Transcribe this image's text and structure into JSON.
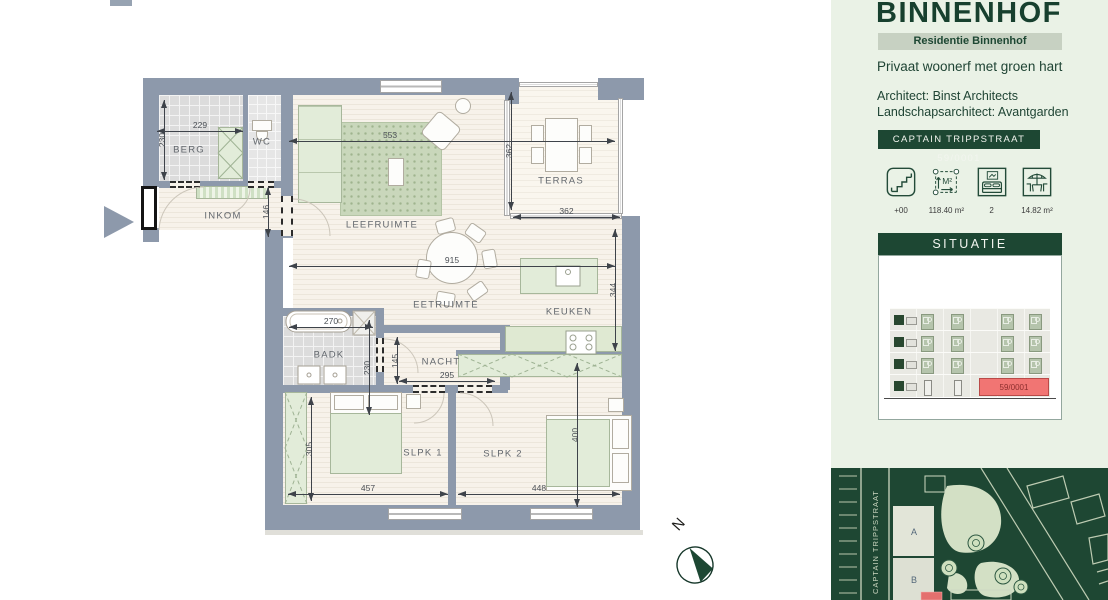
{
  "sidebar": {
    "title": "BINNENHOF",
    "badge": "Residentie Binnenhof",
    "tagline": "Privaat woonerf met groen hart",
    "architect_line1": "Architect: Binst Architects",
    "architect_line2": "Landschapsarchitect: Avantgarden",
    "address_bar": "CAPTAIN TRIPPSTRAAT 59/0001",
    "stats": [
      {
        "icon": "stairs-icon",
        "label": "+00"
      },
      {
        "icon": "area-icon",
        "label": "118.40 m²",
        "glyph": "M²"
      },
      {
        "icon": "bed-icon",
        "label": "2"
      },
      {
        "icon": "terrace-icon",
        "label": "14.82 m²"
      }
    ],
    "situatie": {
      "header": "SITUATIE",
      "highlight_unit": "59/0001"
    },
    "map": {
      "street": "CAPTAIN TRIPPSTRAAT",
      "building_a": "A",
      "building_b": "B"
    }
  },
  "plan": {
    "compass_label": "N",
    "rooms": {
      "berg": "BERG",
      "wc": "WC",
      "inkom": "INKOM",
      "leefruimte": "LEEFRUIMTE",
      "terras": "TERRAS",
      "eetruimte": "EETRUIMTE",
      "keuken": "KEUKEN",
      "badk": "BADK",
      "nacht": "NACHT",
      "slpk1": "SLPK 1",
      "slpk2": "SLPK 2"
    },
    "dims": {
      "berg_w": "229",
      "berg_h": "230",
      "inkom_h": "146",
      "leefruimte_w": "553",
      "terras_h": "362",
      "terras_w": "362",
      "eetruimte_w": "915",
      "keuken_h": "344",
      "badk_w": "270",
      "badk_h": "230",
      "nacht_h": "145",
      "nacht_w": "295",
      "slpk1_h": "305",
      "slpk1_w": "457",
      "slpk2_h": "400",
      "slpk2_w": "448"
    }
  },
  "colors": {
    "accent_green": "#1d4733",
    "wall_gray": "#8d99ab",
    "highlight_red": "#f17573",
    "sidebar_bg": "#eaf2e6"
  }
}
